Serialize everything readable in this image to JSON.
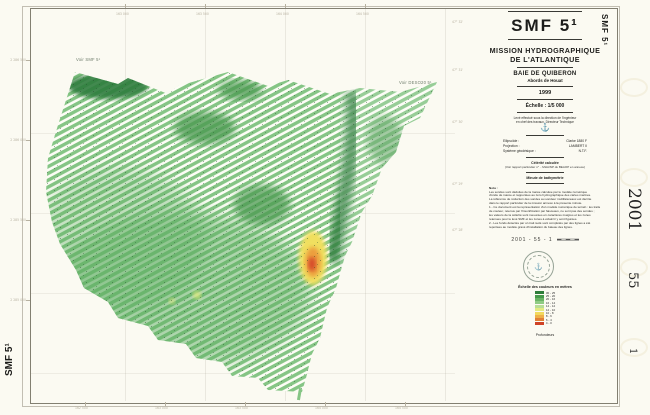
{
  "sheet": {
    "background": "#fbfaf2",
    "frame_color": "#5a5546"
  },
  "title_block": {
    "code": "SMF 5¹",
    "org_line1": "MISSION HYDROGRAPHIQUE",
    "org_line2": "DE L'ATLANTIQUE",
    "area": "BAIE DE QUIBERON",
    "sub_area": "Abords de Houat",
    "year": "1999",
    "scale": "Échelle : 1/5 000",
    "conducted_line1": "Levé effectué sous la direction de l'ingénieur",
    "conducted_line2": "en chef des travaux, Directeur Technique",
    "anchor_icon": "⚓",
    "geodesy_rows": [
      [
        "Ellipsoïde :",
        "Clarke 1880 F"
      ],
      [
        "Projection :",
        "LAMBERT II"
      ],
      [
        "Système géodésique :",
        "N.T.F."
      ]
    ],
    "celerite_title": "Célérité calculée",
    "celerite_note": "(Voir rapport particulier n° .. MHA/NP du BEAOP en annexe)",
    "minute_label": "Minute de bathymétrie",
    "nota_label": "Nota :",
    "nota_lines": [
      "Les sondes sont déduites de la marée calculée par le modèle numérique",
      "d'onde de marée et rapportées au zéro hydrographique des cartes marines.",
      "La référence de réduction des sondes au sondeur multifaisceaux est décrite",
      "dans le rapport particulier de la mission annexé à la présente minute.",
      "1 - Ce document est la représentation d'un modèle numérique de terrain : les traits",
      "de couleur, retenus par l'insonification par faisceaux, ne sont pas des sondes ;",
      "les valeurs de la célérité sont mesurées en caractères maigres et les zones",
      "retenues pour le levé SMF et les zones à éclaircir y sont figurées.",
      "2 - Les fonds détectés par un trait isolé sont complétés par des lignes a été",
      "reportées au modèle gravé d'installation du bateau des lignes."
    ],
    "ref_number": "2001 - 55 - 1"
  },
  "legend": {
    "title": "Échelle des couleurs en mètres",
    "footer": "Profondeurs",
    "rows": [
      {
        "color": "#2e7d3a",
        "label": "30 - 25"
      },
      {
        "color": "#479a4c",
        "label": "25 - 20"
      },
      {
        "color": "#6ab465",
        "label": "20 - 16"
      },
      {
        "color": "#8fcb84",
        "label": "16 - 14"
      },
      {
        "color": "#b8dd96",
        "label": "14 - 12"
      },
      {
        "color": "#e2ea82",
        "label": "12 - 10"
      },
      {
        "color": "#f2d95e",
        "label": "10 - 8"
      },
      {
        "color": "#eeb049",
        "label": "8 - 6"
      },
      {
        "color": "#e07f36",
        "label": "6 - 4"
      },
      {
        "color": "#cf4226",
        "label": "4 - 0"
      }
    ]
  },
  "map": {
    "label_left": "Voir SMF 5¹",
    "label_right": "Voir DESO20 5¹",
    "stripe_color": "#85c585",
    "deep_color": "#2f7d3c",
    "medium_color": "#4c9a51",
    "wash_color": "#5fae63",
    "shallow_yellow": "#f0df5e",
    "shallow_orange": "#ec9e3e",
    "shallow_red": "#d64b2a",
    "sounding_dot_color": "#23482a"
  },
  "margins": {
    "right": {
      "code": "SMF 5¹",
      "year": "2001",
      "series": "55",
      "sheet": "1"
    },
    "left": {
      "code": "SMF 5¹"
    },
    "bottom_ticks": [
      "162 500",
      "163 000",
      "163 500",
      "164 000",
      "164 500"
    ],
    "left_ticks": [
      "2 286 500",
      "2 286 000",
      "2 285 500",
      "2 285 000"
    ],
    "top_ticks": [
      "163 000",
      "163 500",
      "164 000",
      "164 500"
    ],
    "inner_ticks": [
      "47° 32'",
      "47° 31'",
      "47° 30'",
      "47° 29'",
      "47° 28'"
    ]
  }
}
